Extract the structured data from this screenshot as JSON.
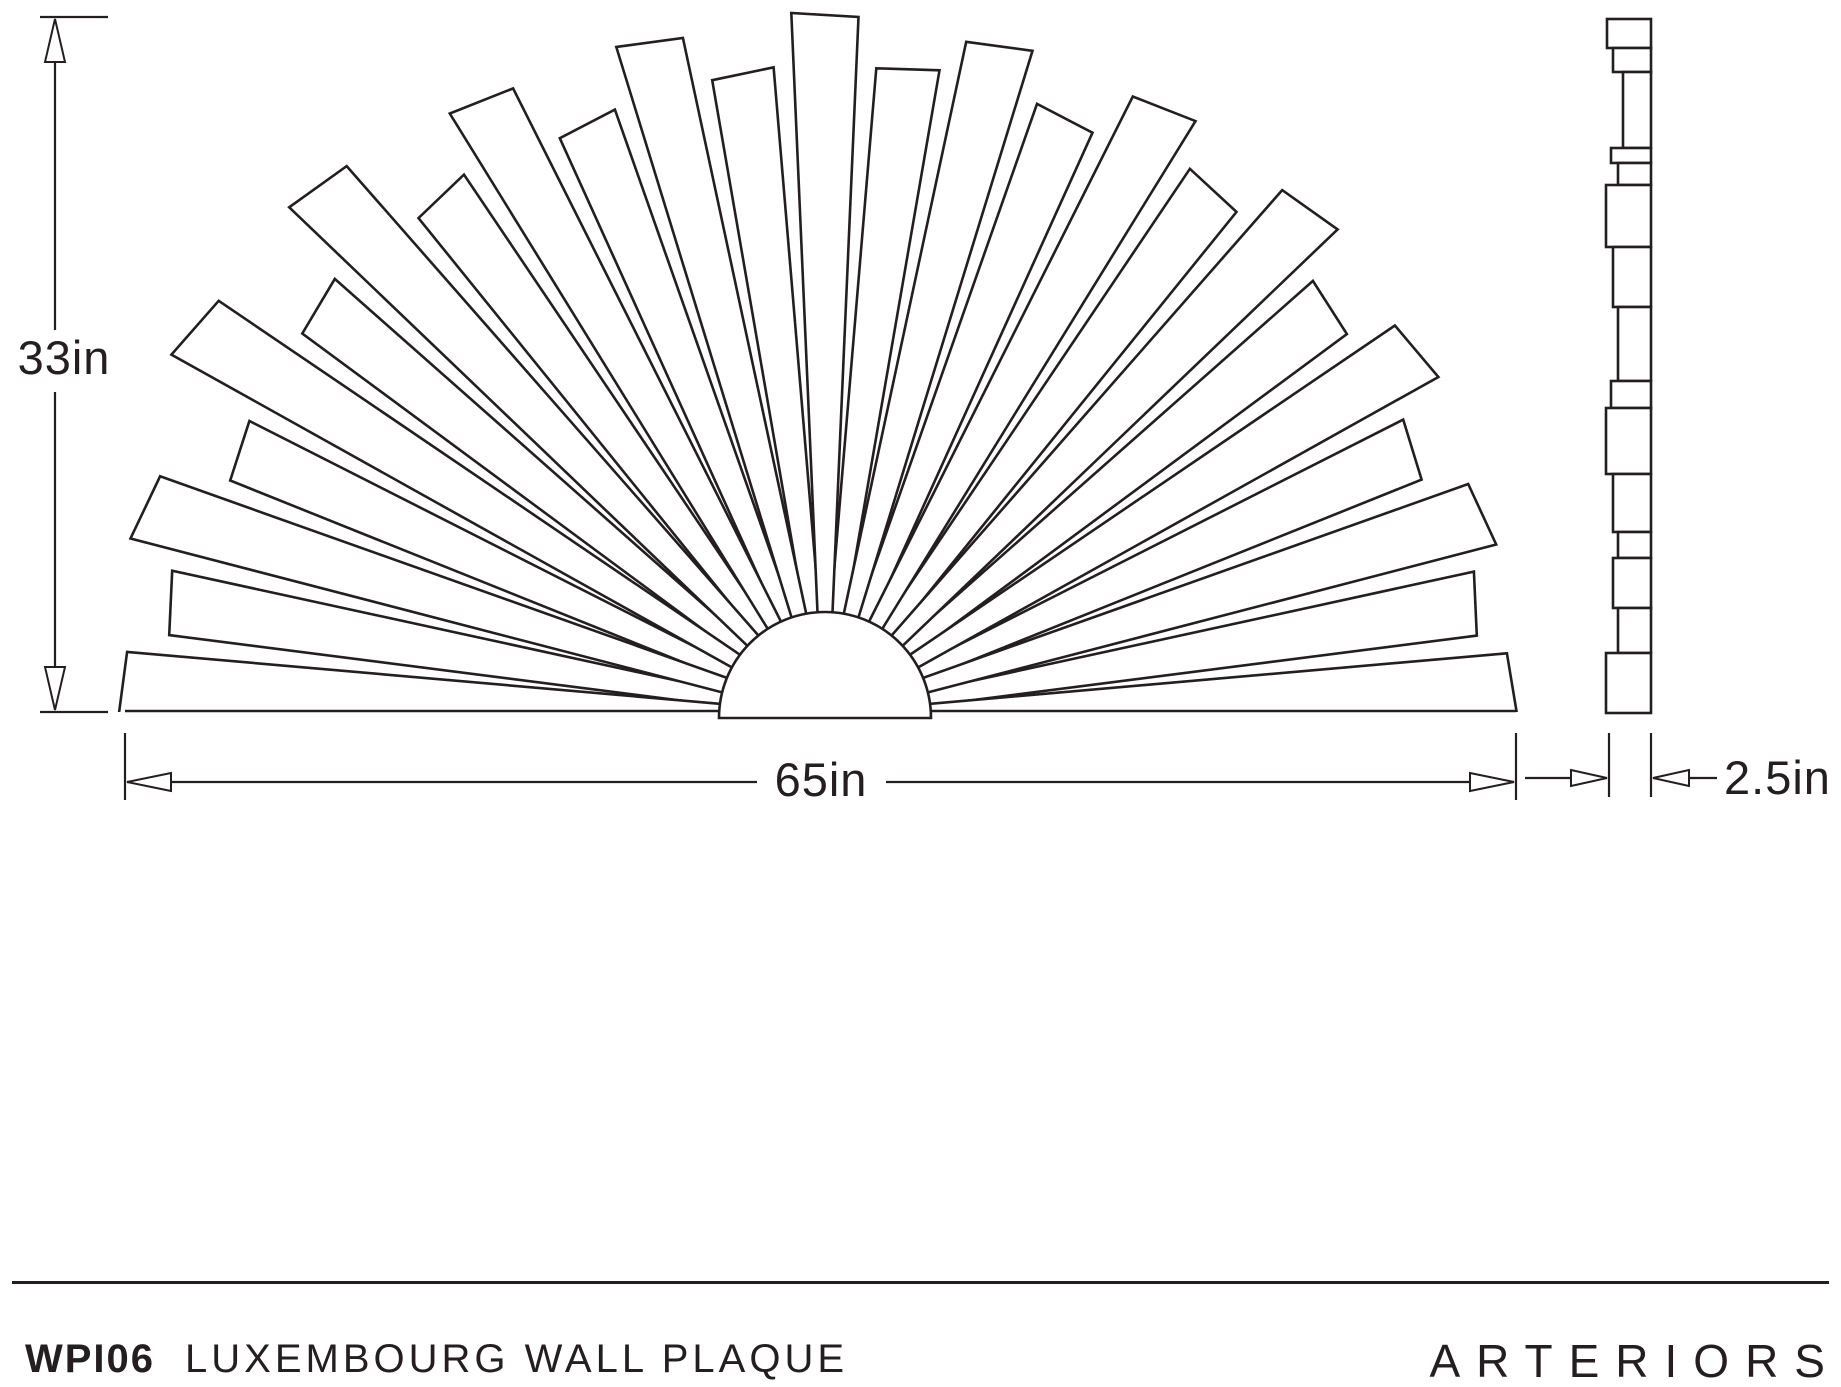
{
  "page": {
    "background": "#ffffff",
    "ink_color": "#231f20"
  },
  "dimensions": {
    "height": {
      "label": "33in"
    },
    "width": {
      "label": "65in"
    },
    "depth": {
      "label": "2.5in"
    }
  },
  "footer": {
    "product_code": "WPI06",
    "product_name": "LUXEMBOURG WALL PLAQUE",
    "brand": "ARTERIORS"
  },
  "drawing": {
    "fan": {
      "center": [
        825,
        716
      ],
      "inner_radius": 90,
      "baseline_y": 712,
      "hub": {
        "cx": 825,
        "cy": 718,
        "r": 106
      },
      "edge_margin": 3,
      "edge_angle_deg": 2.5,
      "planks": [
        {
          "angle": 177.5,
          "layer": "front",
          "r": 700,
          "tilt": -6
        },
        {
          "angle": 170.21,
          "layer": "back",
          "r": 668,
          "tilt": 8
        },
        {
          "angle": 162.92,
          "layer": "front",
          "r": 706,
          "tilt": -10
        },
        {
          "angle": 155.63,
          "layer": "back",
          "r": 646,
          "tilt": 7
        },
        {
          "angle": 148.33,
          "layer": "front",
          "r": 734,
          "tilt": -12
        },
        {
          "angle": 141.04,
          "layer": "back",
          "r": 656,
          "tilt": 9
        },
        {
          "angle": 133.75,
          "layer": "front",
          "r": 728,
          "tilt": -10
        },
        {
          "angle": 126.46,
          "layer": "back",
          "r": 650,
          "tilt": 8
        },
        {
          "angle": 119.17,
          "layer": "front",
          "r": 700,
          "tilt": -9
        },
        {
          "angle": 111.88,
          "layer": "back",
          "r": 641,
          "tilt": 6
        },
        {
          "angle": 104.58,
          "layer": "front",
          "r": 692,
          "tilt": -8
        },
        {
          "angle": 97.29,
          "layer": "back",
          "r": 650,
          "tilt": 5
        },
        {
          "angle": 90.0,
          "layer": "front",
          "r": 699,
          "tilt": -4
        },
        {
          "angle": 82.71,
          "layer": "back",
          "r": 655,
          "tilt": 6
        },
        {
          "angle": 75.42,
          "layer": "front",
          "r": 696,
          "tilt": 8
        },
        {
          "angle": 68.13,
          "layer": "back",
          "r": 641,
          "tilt": -6
        },
        {
          "angle": 60.83,
          "layer": "front",
          "r": 700,
          "tilt": 9
        },
        {
          "angle": 53.54,
          "layer": "back",
          "r": 650,
          "tilt": -7
        },
        {
          "angle": 46.25,
          "layer": "front",
          "r": 706,
          "tilt": 10
        },
        {
          "angle": 38.96,
          "layer": "back",
          "r": 646,
          "tilt": -7
        },
        {
          "angle": 31.67,
          "layer": "front",
          "r": 700,
          "tilt": 10
        },
        {
          "angle": 24.38,
          "layer": "back",
          "r": 641,
          "tilt": -8
        },
        {
          "angle": 17.08,
          "layer": "front",
          "r": 692,
          "tilt": 9
        },
        {
          "angle": 9.79,
          "layer": "back",
          "r": 656,
          "tilt": -8
        },
        {
          "angle": 2.5,
          "layer": "front",
          "r": 692,
          "tilt": 8
        }
      ]
    },
    "side_view": {
      "right_x": 1651,
      "blocks": [
        {
          "y1": 19,
          "y2": 48,
          "left": 1607
        },
        {
          "y1": 48,
          "y2": 72,
          "left": 1613
        },
        {
          "y1": 72,
          "y2": 148,
          "left": 1623
        },
        {
          "y1": 148,
          "y2": 163,
          "left": 1611
        },
        {
          "y1": 163,
          "y2": 185,
          "left": 1618
        },
        {
          "y1": 185,
          "y2": 247,
          "left": 1606
        },
        {
          "y1": 247,
          "y2": 307,
          "left": 1613
        },
        {
          "y1": 307,
          "y2": 381,
          "left": 1618
        },
        {
          "y1": 381,
          "y2": 408,
          "left": 1611
        },
        {
          "y1": 408,
          "y2": 474,
          "left": 1606
        },
        {
          "y1": 474,
          "y2": 532,
          "left": 1613
        },
        {
          "y1": 532,
          "y2": 558,
          "left": 1618
        },
        {
          "y1": 558,
          "y2": 608,
          "left": 1613
        },
        {
          "y1": 608,
          "y2": 653,
          "left": 1618
        },
        {
          "y1": 653,
          "y2": 713,
          "left": 1606
        }
      ]
    }
  }
}
